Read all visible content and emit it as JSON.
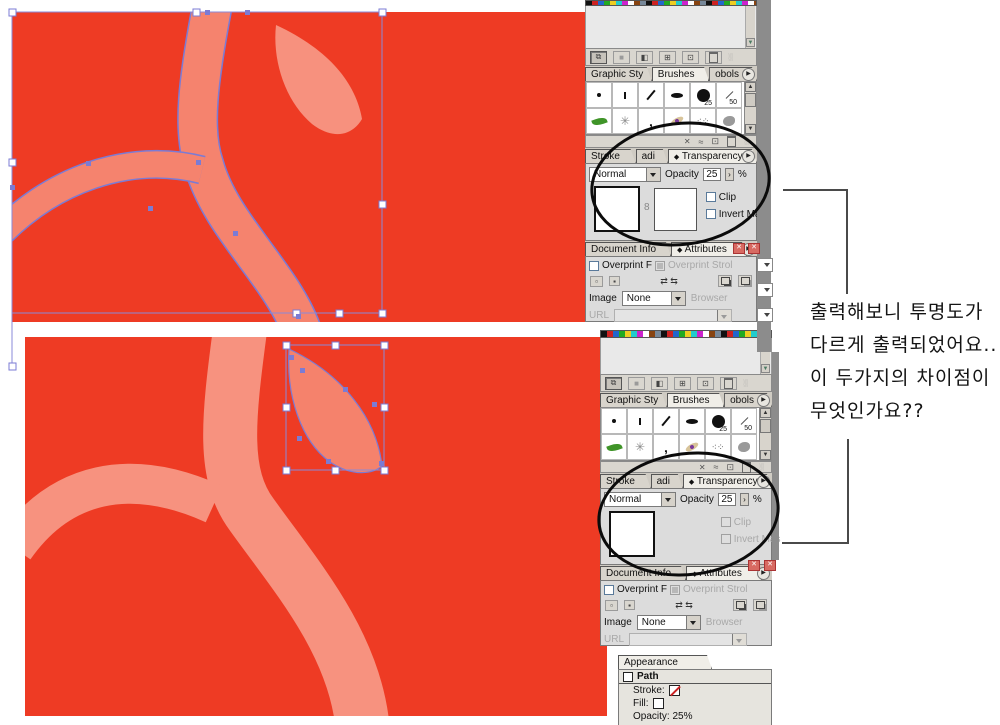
{
  "colors": {
    "canvas_red": "#EE3B24",
    "branch_top": "#F5836E",
    "leaf_top": "#F7917E",
    "branch_bottom": "#F7927F",
    "leaf_bottom": "#F5826C",
    "selection_blue": "#7B7BD4",
    "panel_gray": "#DCDCDC"
  },
  "panels": {
    "styles_tabs": {
      "tab1": "Graphic Sty",
      "tab2": "Brushes",
      "tab3": "obols"
    },
    "brushes": {
      "b25": "25",
      "b50": "50"
    },
    "stroke_tabs": {
      "tab1": "Stroke",
      "tab2": "adi",
      "tab3": "Transparency",
      "marker": "◆"
    },
    "transparency": {
      "blend_mode": "Normal",
      "opacity_label": "Opacity",
      "opacity_value": "25",
      "percent": "%",
      "clip_label": "Clip",
      "invert_label": "Invert Mas",
      "link_glyph": "8"
    },
    "info_tabs": {
      "tab1": "Document Info",
      "tab2": "Attributes",
      "marker": "◆"
    },
    "attributes": {
      "overprint_fill": "Overprint F",
      "overprint_stroke": "Overprint Strol",
      "image_label": "Image",
      "image_value": "None",
      "browser_label": "Browser",
      "url_label": "URL",
      "swap_arrows": "⇄ ⇆"
    },
    "appearance": {
      "tab": "Appearance",
      "path_label": "Path",
      "stroke_label": "Stroke:",
      "fill_label": "Fill:",
      "opacity_text": "Opacity: 25%"
    }
  },
  "annotation": {
    "line1": "출력해보니 투명도가",
    "line2": "다르게 출력되었어요..",
    "line3": "이 두가지의 차이점이",
    "line4": "무엇인가요??"
  },
  "glyphs": {
    "x": "✕",
    "wave": "≈",
    "newdoc": "⊡",
    "grid": "⊞",
    "layers": "⧉",
    "square": "■",
    "gradient": "◧",
    "grip": "░░",
    "up": "▲",
    "down": "▼",
    "play": "▶"
  }
}
